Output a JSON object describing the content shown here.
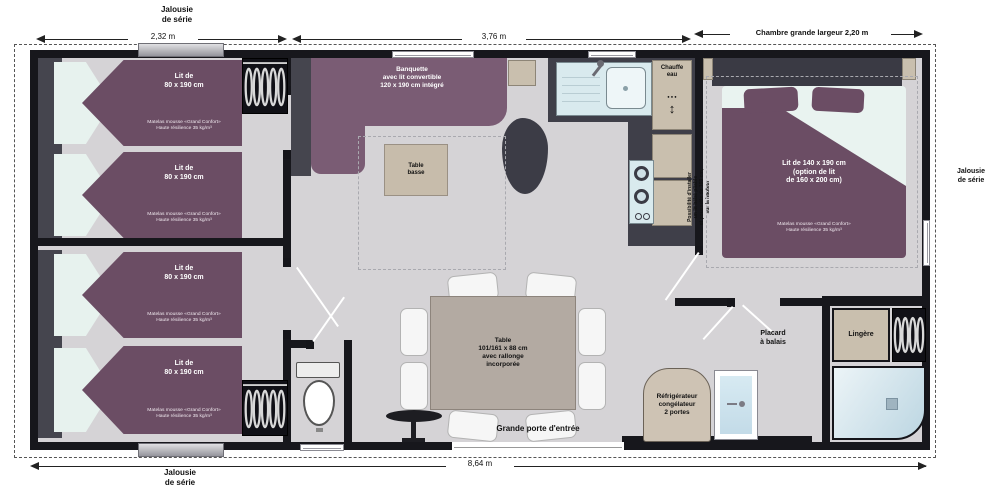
{
  "labels": {
    "jalousie_top": "Jalousie\nde série",
    "jalousie_bottom": "Jalousie\nde série",
    "jalousie_right": "Jalousie\nde série",
    "dim_left": "2,32 m",
    "dim_mid": "3,76 m",
    "dim_room": "Chambre grande largeur 2,20 m",
    "dim_total": "8,64 m"
  },
  "bedroom_small": {
    "bed_title": "Lit de\n80 x 190 cm",
    "mattress": "Matelas mousse «Grand Confort»\nHaute résilience 35 kg/m³"
  },
  "living": {
    "banquette": "Banquette\navec lit convertible\n120 x 190 cm intégré",
    "table_basse": "Table\nbasse",
    "dining_table": "Table\n101/161 x 88 cm\navec rallonge\nincorporée",
    "entrance": "Grande porte d'entrée"
  },
  "kitchen": {
    "chauffe_eau": "Chauffe\neau",
    "fridge": "Réfrigérateur\ncongélateur\n2 portes"
  },
  "master": {
    "bed_title": "Lit de 140 x 190 cm\n(option de lit\nde 160 x 200 cm)",
    "mattress": "Matelas mousse «Grand Confort»\nHaute résilience 35 kg/m³",
    "baby_note": "Possibilité d'installer\nun lit bébé pliable\net poussette de 103 cm,\nsur la hauteur"
  },
  "storage": {
    "lingere": "Lingère",
    "placard": "Placard\nà balais"
  },
  "icons": {
    "chauffe_dots": "● ● ●",
    "chauffe_arrow": "↕"
  }
}
